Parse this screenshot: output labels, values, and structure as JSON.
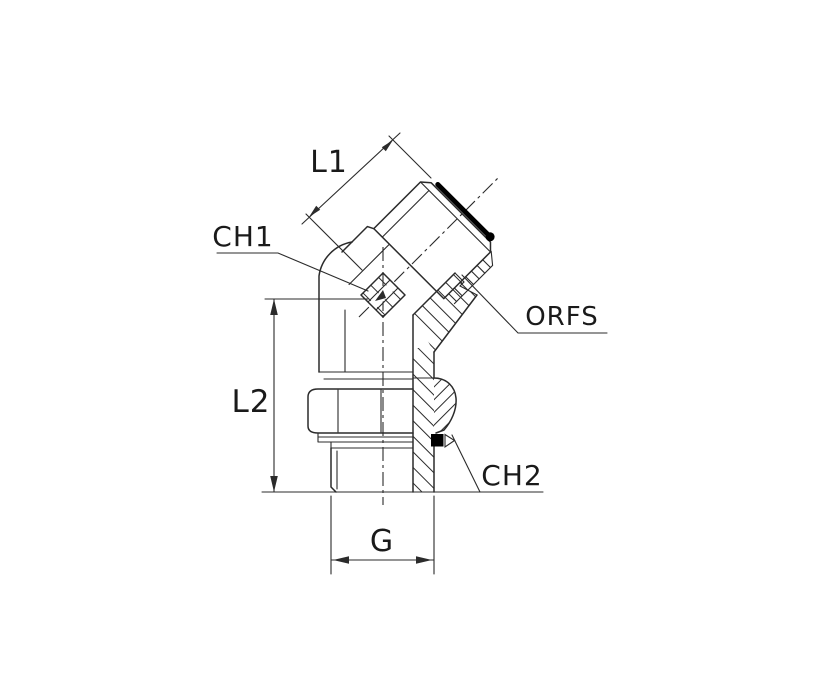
{
  "drawing": {
    "labels": {
      "l1": "L1",
      "ch1": "CH1",
      "l2": "L2",
      "orfs": "ORFS",
      "ch2": "CH2",
      "g": "G"
    },
    "colors": {
      "line": "#2b2b2b",
      "text": "#1a1a1a",
      "o_ring": "#000000",
      "background": "#ffffff"
    }
  }
}
